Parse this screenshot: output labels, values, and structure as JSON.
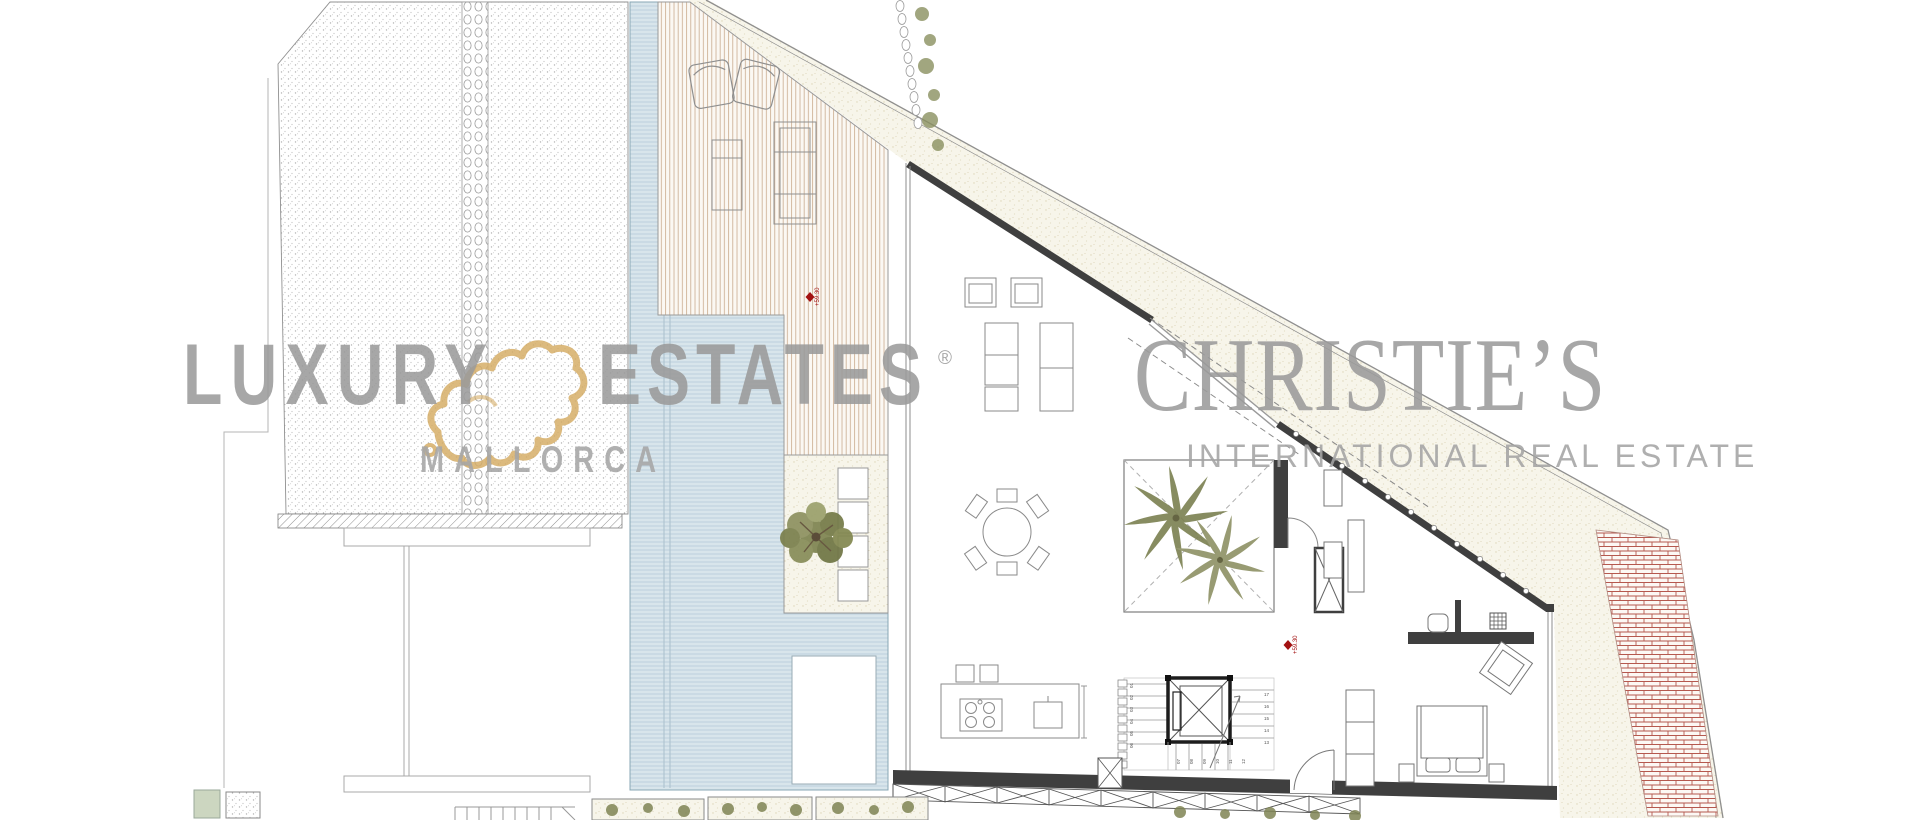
{
  "page": {
    "background": "#ffffff",
    "content": "architectural floor plan with brokerage watermarks"
  },
  "watermarks": {
    "left_brand": {
      "word_primary": "LUXURY",
      "word_secondary": "ESTATES",
      "registered_mark": "®",
      "subtitle": "MALLORCA",
      "logo": "mallorca-island-outline",
      "text_color": "#9b9b9b",
      "logo_color": "#d6ae68"
    },
    "right_brand": {
      "title": "CHRISTIE’S",
      "subtitle": "INTERNATIONAL REAL ESTATE",
      "text_color": "#9b9b9b"
    }
  },
  "plan": {
    "level_markers": [
      {
        "id": "deck-level",
        "value": "+59.30",
        "color": "#a31212"
      },
      {
        "id": "hall-level",
        "value": "+59.30",
        "color": "#a31212"
      }
    ],
    "stair_numbers": {
      "left_flight": [
        "01",
        "02",
        "03",
        "04",
        "05",
        "06"
      ],
      "lower_flight": [
        "07",
        "08",
        "09",
        "10",
        "11",
        "12"
      ],
      "right_flight": [
        "17",
        "16",
        "15",
        "14",
        "13"
      ]
    },
    "materials": {
      "pool_water": "#d8e5eb",
      "deck_wood_line": "#c9aa8d",
      "gravel": "#f7f5ea",
      "wall_dark": "#3f3f3f",
      "brick_red": "#b5584e",
      "plant_olive": "#7d8352",
      "stipple_gray": "#b4b4b4"
    }
  }
}
